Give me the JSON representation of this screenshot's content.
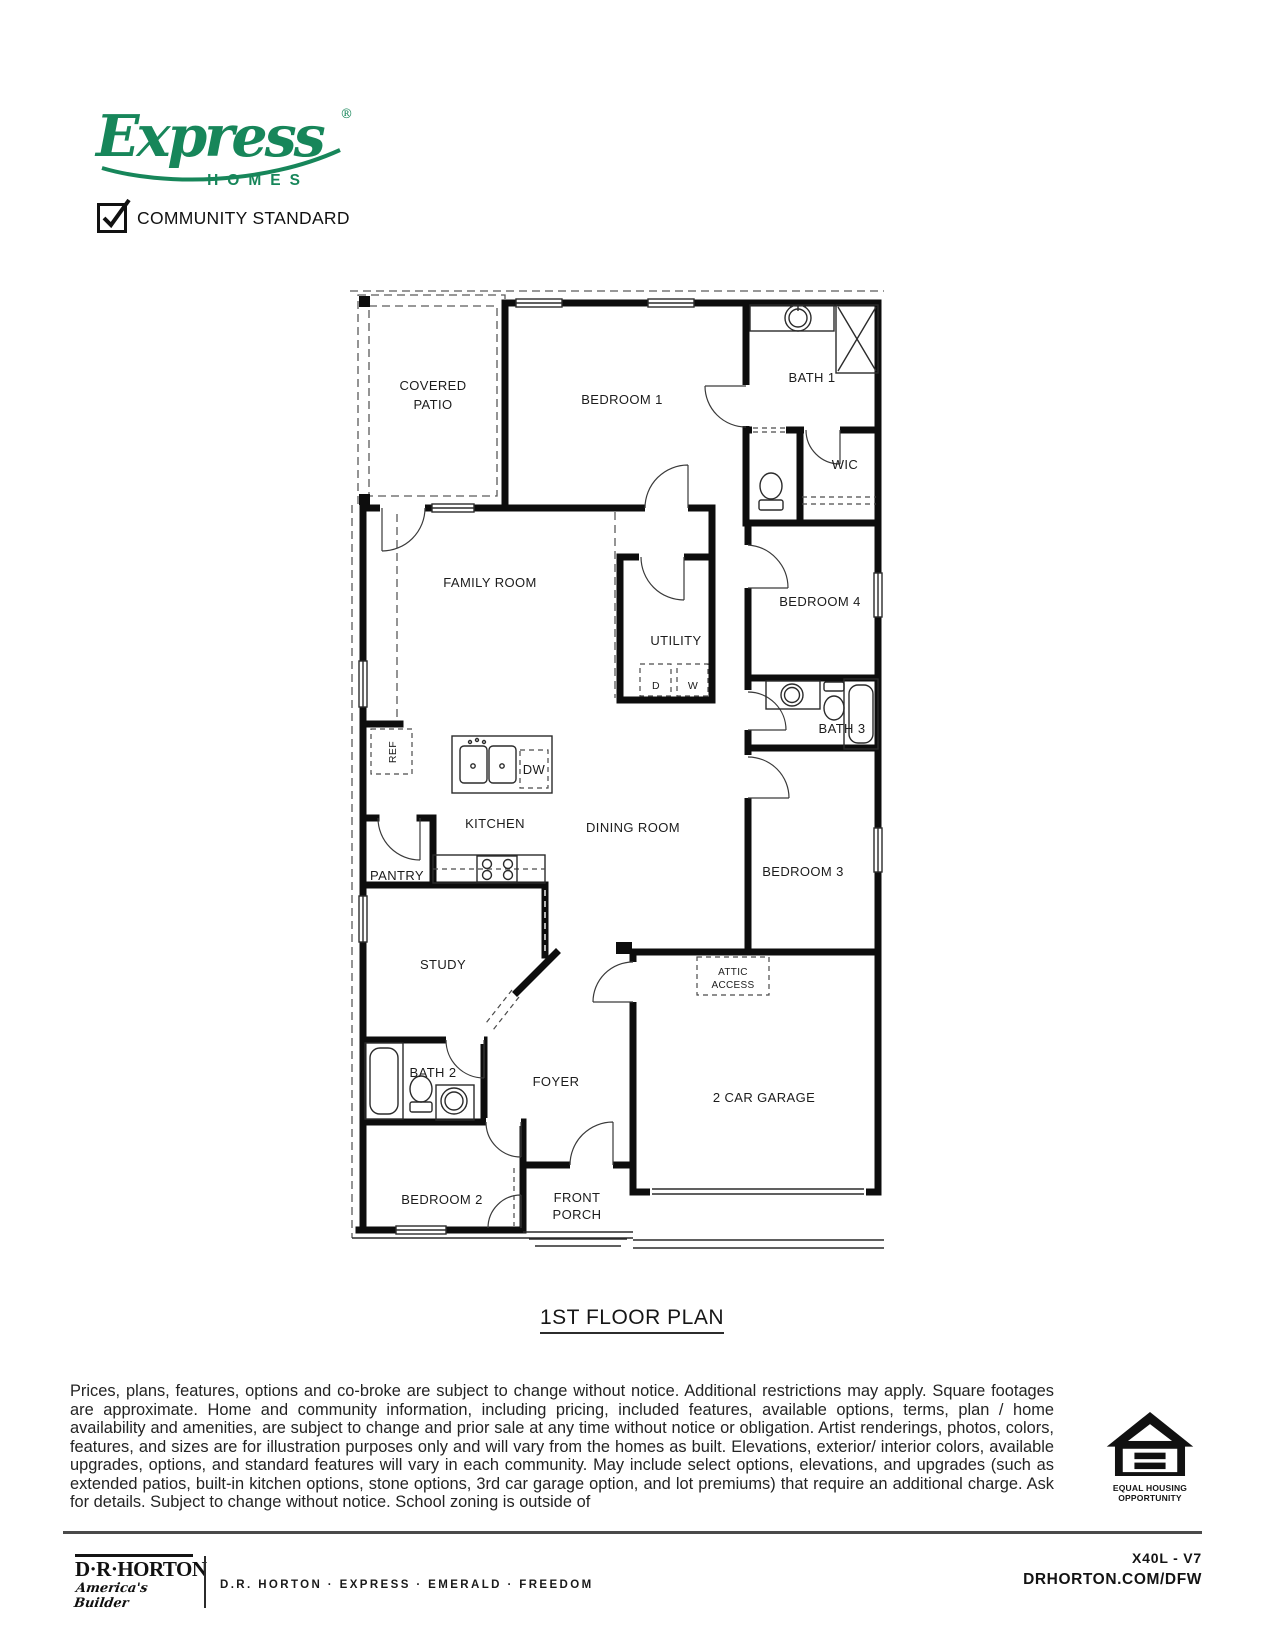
{
  "brand": {
    "logo_script": "Express",
    "registered": "®",
    "logo_sub": "HOMES",
    "checkbox_label": "COMMUNITY STANDARD",
    "green": "#17865a"
  },
  "plan": {
    "title": "1ST FLOOR PLAN",
    "labels": {
      "covered_patio_1": "COVERED",
      "covered_patio_2": "PATIO",
      "bedroom1": "BEDROOM 1",
      "bath1": "BATH 1",
      "wic": "WIC",
      "family_room": "FAMILY ROOM",
      "utility": "UTILITY",
      "bedroom4": "BEDROOM 4",
      "bath3": "BATH 3",
      "ref": "REF",
      "kitchen": "KITCHEN",
      "dining_room": "DINING ROOM",
      "bedroom3": "BEDROOM 3",
      "pantry": "PANTRY",
      "study": "STUDY",
      "attic_1": "ATTIC",
      "attic_2": "ACCESS",
      "bath2": "BATH 2",
      "foyer": "FOYER",
      "garage": "2 CAR GARAGE",
      "bedroom2": "BEDROOM 2",
      "front_porch_1": "FRONT",
      "front_porch_2": "PORCH",
      "d": "D",
      "w": "W",
      "dw": "DW"
    }
  },
  "disclaimer": "Prices, plans, features, options and co-broke are subject to change without notice. Additional restrictions may apply.  Square footages are approximate. Home and community information, including pricing, included features, available options, terms, plan / home availability and amenities, are subject to change and prior sale at any time without notice or obligation. Artist renderings, photos, colors, features, and sizes are for illustration purposes only and will vary from the homes as built. Elevations, exterior/ interior colors, available upgrades, options, and standard features will vary in each community. May include select options, elevations, and upgrades (such as extended patios, built-in kitchen options, stone options, 3rd car garage option, and lot premiums) that require an additional charge. Ask for details. Subject to change without notice. School zoning is outside of",
  "eho": {
    "line1": "EQUAL HOUSING",
    "line2": "OPPORTUNITY"
  },
  "footer": {
    "logo_name": "D·R·HORTON",
    "logo_tagline": "America's Builder",
    "brands": "D.R. HORTON · EXPRESS · EMERALD · FREEDOM",
    "plan_code": "X40L - V7",
    "website": "DRHORTON.COM/DFW"
  }
}
